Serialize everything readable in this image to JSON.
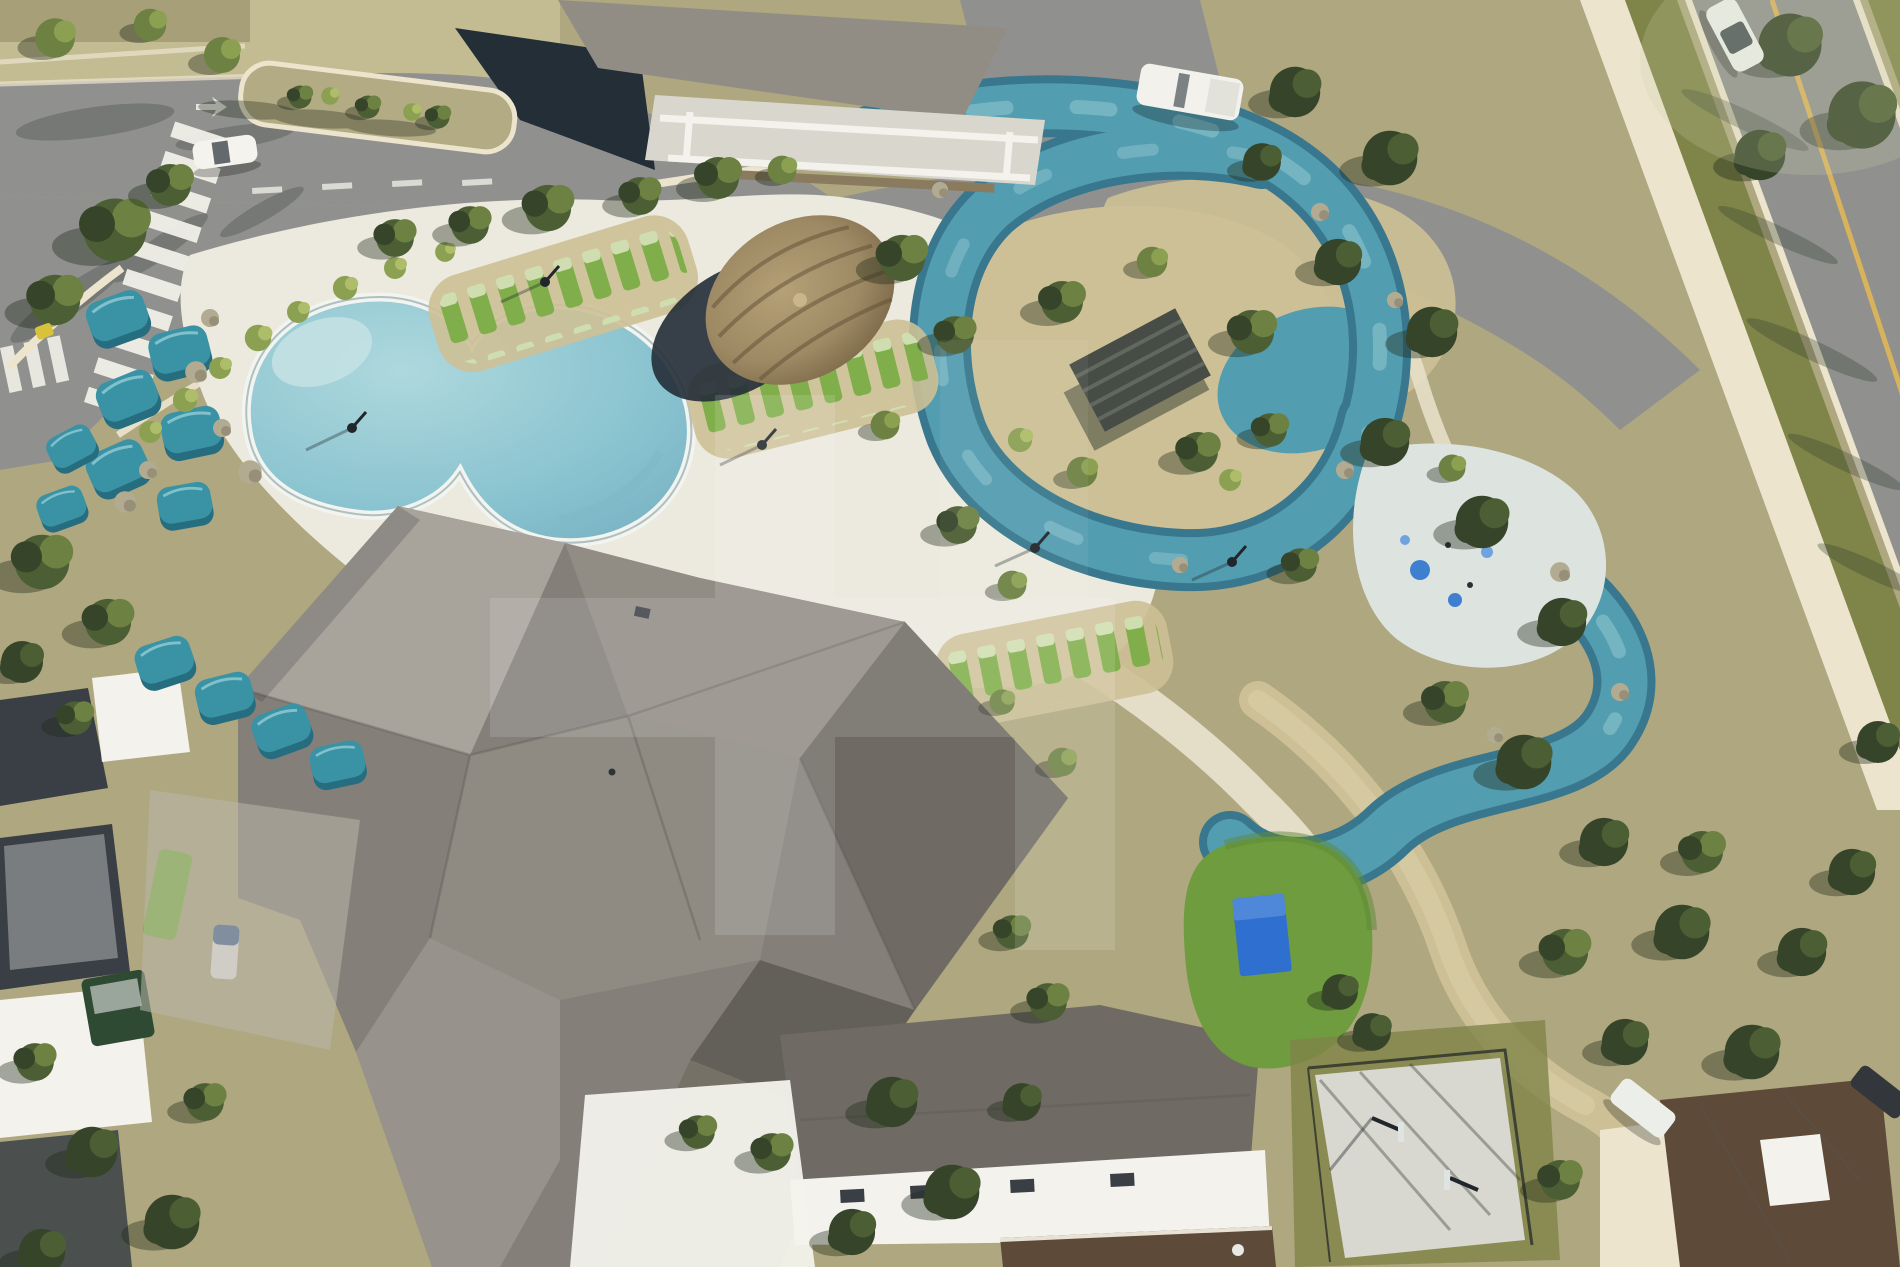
{
  "image": {
    "kind": "aerial-drone-photo",
    "width": 1900,
    "height": 1267
  },
  "scene": {
    "description": "Aerial drone photo of a community amenity center: freeform resort pool with teal cabanas, a lazy river winding through dense landscaping, a thatched tiki hut, a large multi-gabled gray clubhouse roof, splash pad, event lawn with blue game mat, basketball half-court, bordering streets with a crosswalk, parked white vehicles and neighboring rooftops.",
    "watermark": {
      "present": true,
      "shape": "translucent geometric monogram",
      "color": "#ffffff",
      "opacity": 0.13,
      "opacity_faint": 0.06
    }
  },
  "palette": {
    "ground_tan": "#aea77f",
    "ground_tan_light": "#c3bb92",
    "ground_sand": "#cdc096",
    "curb_cream": "#ece4cd",
    "deck_white": "#eceade",
    "white": "#f3f2ec",
    "road_gray": "#90918f",
    "road_dark": "#7b7c7a",
    "shadow_navy": "#232e37",
    "grass_olive": "#7f8449",
    "lawn_green": "#6f9c3e",
    "court_gray": "#d8d8d0",
    "mat_blue": "#2f6fd0",
    "cabana_teal": "#3a93a5",
    "cabana_teal_dark": "#276d80",
    "tree_green": "#4c5e33",
    "tree_green_light": "#6d8142",
    "tree_green_dark": "#36452a",
    "shrub_green": "#8ca052",
    "rock_gray": "#b2ab92",
    "roof_light": "#a8a39b",
    "roof_mid": "#918d85",
    "roof_base": "#847f79",
    "roof_dark": "#6f6b64",
    "roof_darker": "#635f59",
    "river_teal": "#539db0",
    "river_edge": "#38778d",
    "river_light": "#a9d8dd",
    "pool_blue": "#aed8dd",
    "pool_blue_deep": "#88c2cf",
    "hut_thatch": "#9d8963",
    "hut_thatch_dark": "#6d5a3c",
    "line_yellow": "#d9b35c",
    "wall_brown": "#5d4a39",
    "house_roof_dark": "#3a3f45",
    "lounger_green": "#7fae4a"
  },
  "features": [
    {
      "name": "main-pool",
      "label": "Freeform resort pool"
    },
    {
      "name": "lazy-river",
      "label": "Lazy river"
    },
    {
      "name": "splash-pad",
      "label": "Splash pad"
    },
    {
      "name": "tiki-hut",
      "label": "Thatched tiki hut"
    },
    {
      "name": "pergola-island",
      "label": "Island pergola"
    },
    {
      "name": "clubhouse-roof",
      "label": "Clubhouse roof"
    },
    {
      "name": "cabanas",
      "label": "Teal shade cabanas"
    },
    {
      "name": "lounge-chairs",
      "label": "Rows of lounge chairs"
    },
    {
      "name": "basketball-court",
      "label": "Basketball half-court"
    },
    {
      "name": "event-lawn",
      "label": "Event lawn with game mat"
    },
    {
      "name": "crosswalk",
      "label": "Street crosswalk"
    },
    {
      "name": "streets",
      "label": "Community streets"
    },
    {
      "name": "vehicles",
      "label": "Parked cars and truck"
    },
    {
      "name": "homes",
      "label": "Neighboring rooftops"
    },
    {
      "name": "trees",
      "label": "Mature trees and landscaping"
    }
  ]
}
